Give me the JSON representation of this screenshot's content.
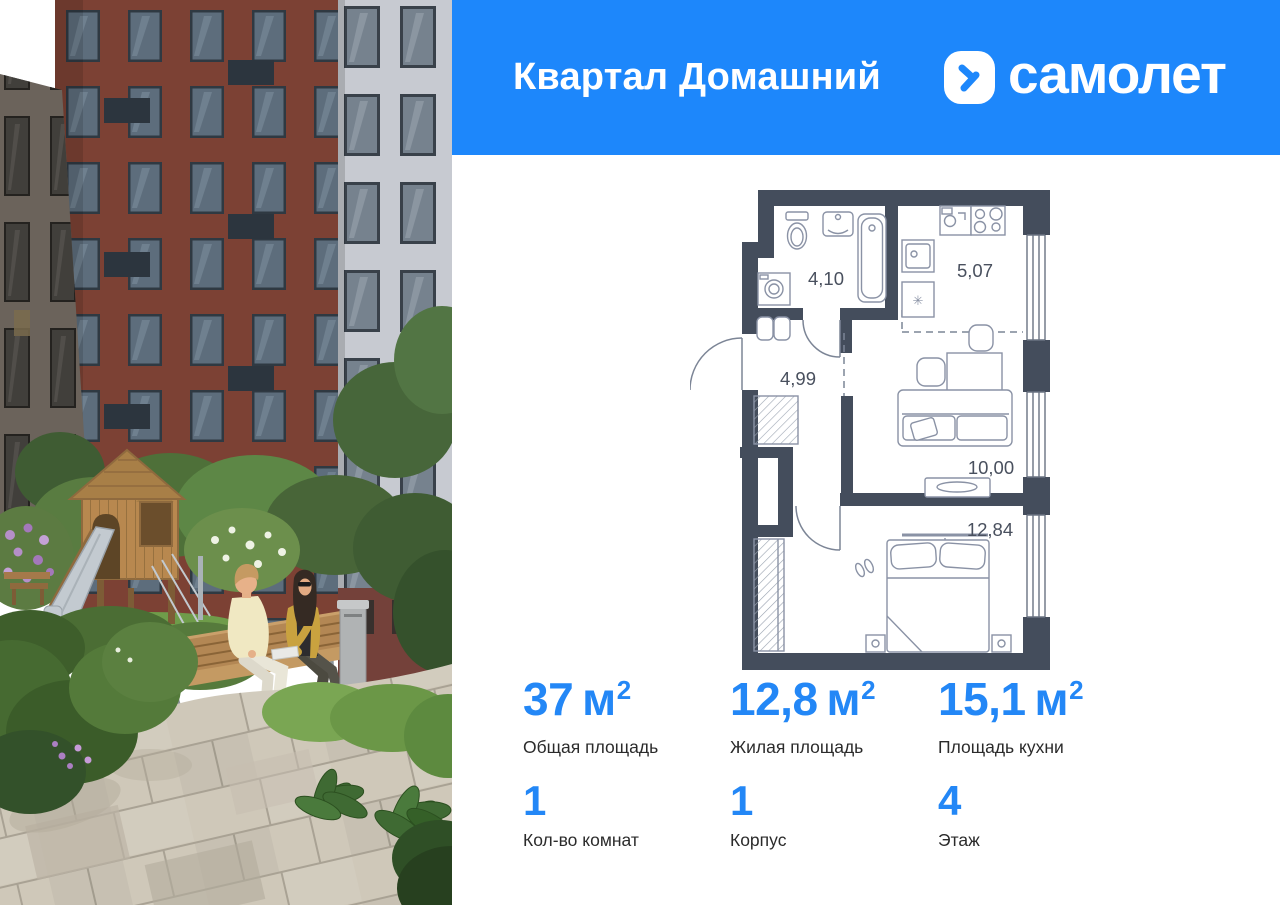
{
  "header": {
    "project_title": "Квартал Домашний",
    "brand_name": "самолет",
    "background_color": "#1d87fb"
  },
  "floor_plan": {
    "wall_color": "#444d5c",
    "rooms": [
      {
        "name": "bathroom",
        "area": "4,10"
      },
      {
        "name": "hallway",
        "area": "4,99"
      },
      {
        "name": "kitchen",
        "area": "5,07"
      },
      {
        "name": "kitchen-living",
        "area": "10,00"
      },
      {
        "name": "bedroom",
        "area": "12,84"
      }
    ]
  },
  "stats": {
    "accent_color": "#2387f6",
    "area_stats": [
      {
        "value": "37",
        "unit_base": "м",
        "unit_sup": "2",
        "label": "Общая площадь"
      },
      {
        "value": "12,8",
        "unit_base": "м",
        "unit_sup": "2",
        "label": "Жилая площадь"
      },
      {
        "value": "15,1",
        "unit_base": "м",
        "unit_sup": "2",
        "label": "Площадь кухни"
      }
    ],
    "info_stats": [
      {
        "value": "1",
        "label": "Кол-во комнат"
      },
      {
        "value": "1",
        "label": "Корпус"
      },
      {
        "value": "4",
        "label": "Этаж"
      }
    ]
  }
}
